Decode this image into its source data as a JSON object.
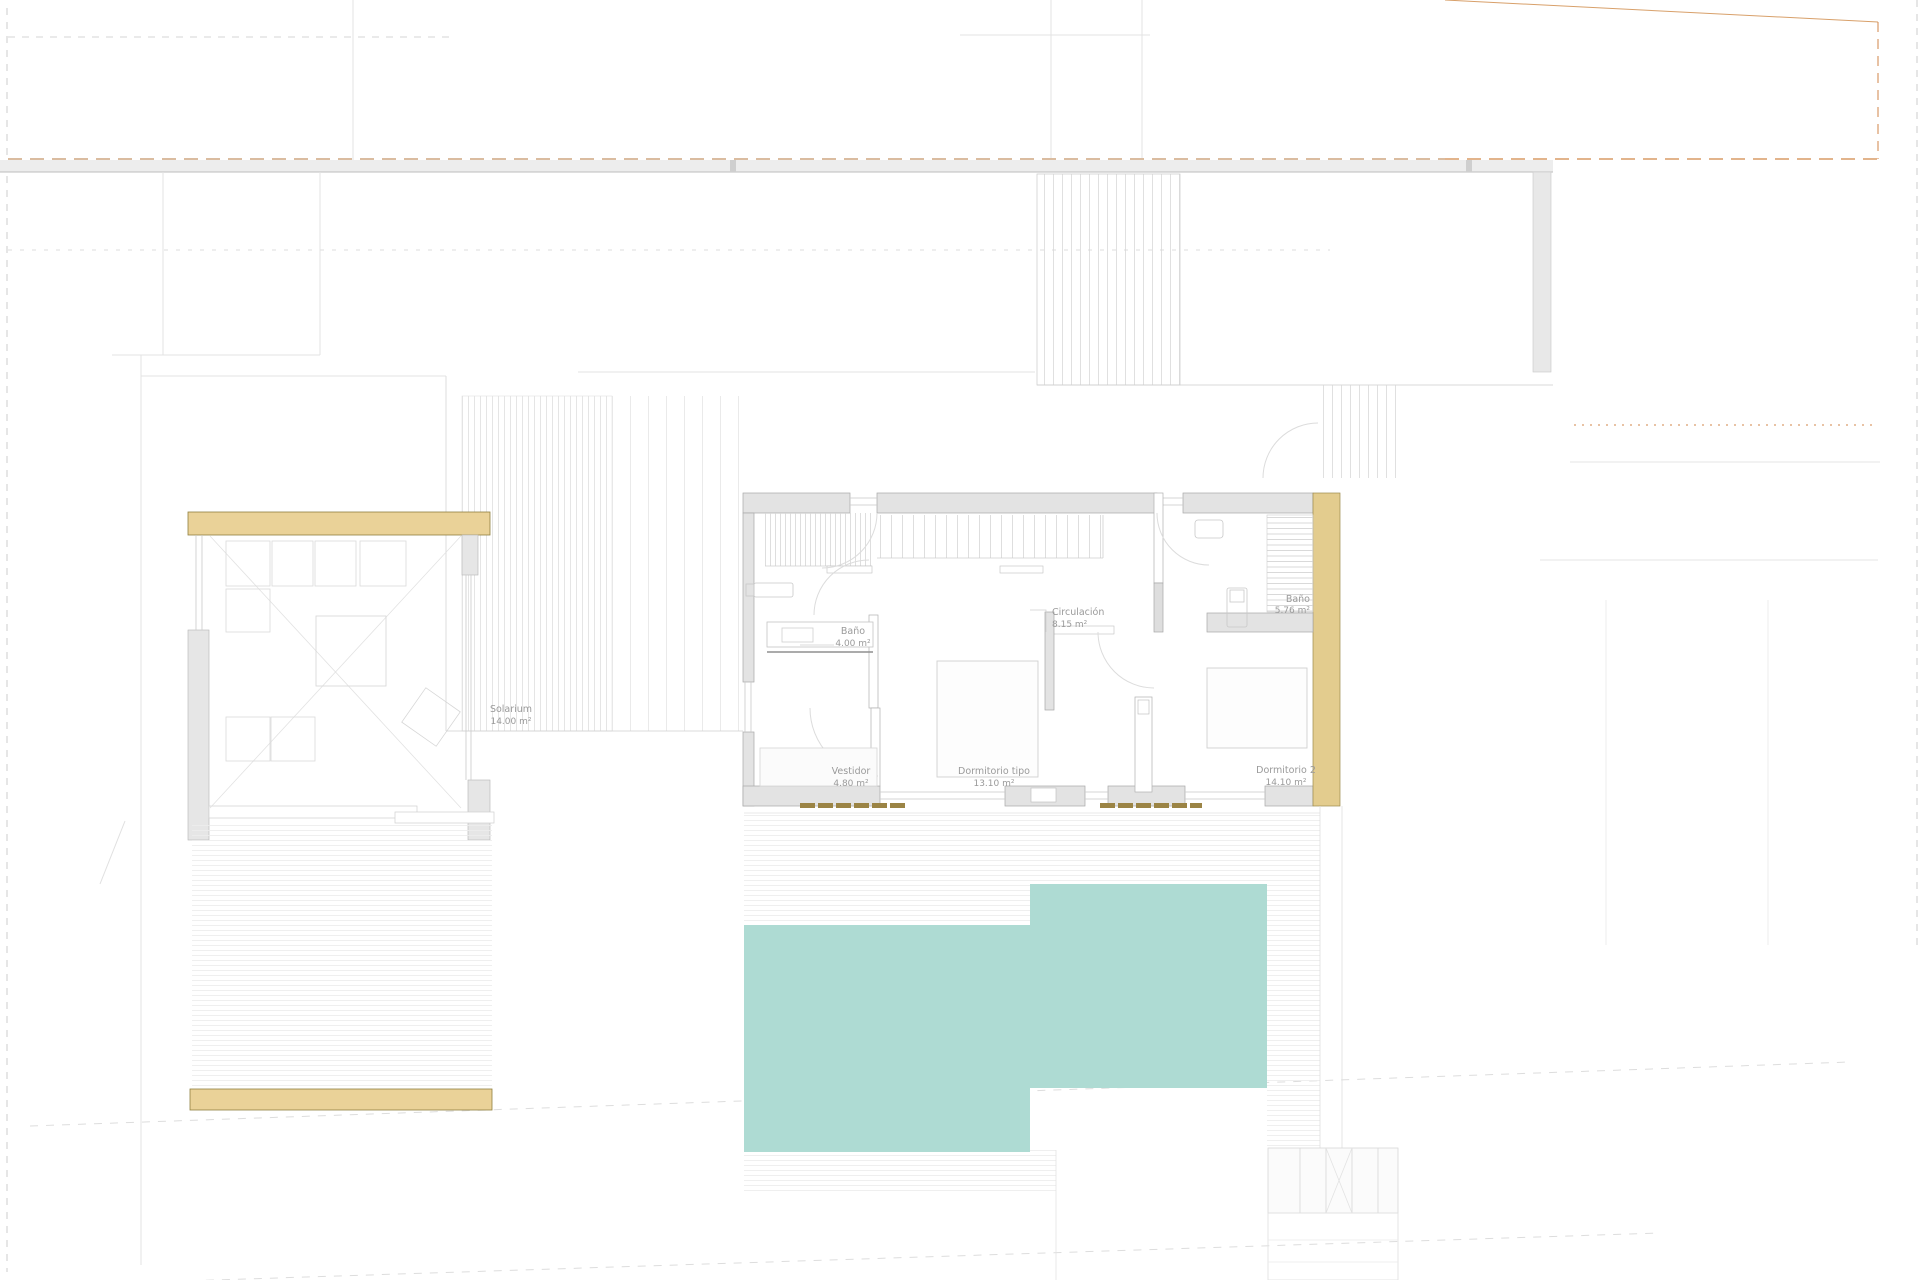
{
  "plan": {
    "kind": "upper-floor site plan",
    "rooms": {
      "solarium": {
        "name": "Solarium",
        "area": "14.00 m²"
      },
      "bathroom_1": {
        "name": "Baño",
        "area": "4.00 m²"
      },
      "circulation": {
        "name": "Circulación",
        "area": "8.15 m²"
      },
      "bathroom_2": {
        "name": "Baño",
        "area": "5.76 m²"
      },
      "dressing_room": {
        "name": "Vestidor",
        "area": "4.80 m²"
      },
      "bedroom_type": {
        "name": "Dormitorio tipo",
        "area": "13.10 m²"
      },
      "bedroom_2": {
        "name": "Dormitorio 2",
        "area": "14.10 m²"
      }
    },
    "colors": {
      "pool": "#aedbd3",
      "wood_band": "#ead298",
      "wood_band_stroke": "#8f7f3f",
      "wood_strip": "#e3cc8e",
      "wood_strip_stroke": "#9c8a4d",
      "louvre": "#9b8445",
      "wall_fill": "#e3e3e3",
      "wall_stroke": "#a8a8a8",
      "boundary_gray": "#cccccc",
      "boundary_tan": "#c49468",
      "boundary_orange": "#d08648",
      "label_text": "#9a9a9a"
    }
  }
}
